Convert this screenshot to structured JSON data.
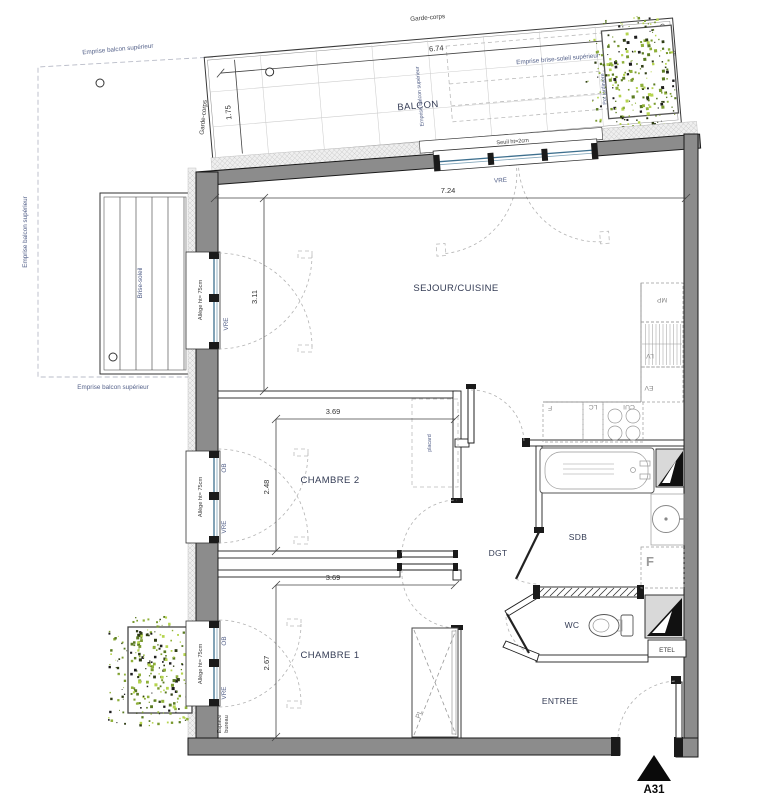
{
  "rooms": {
    "balcon": "BALCON",
    "sejour": "SEJOUR/CUISINE",
    "chambre2": "CHAMBRE 2",
    "chambre1": "CHAMBRE 1",
    "dgt": "DGT",
    "sdb": "SDB",
    "wc": "WC",
    "entree": "ENTREE"
  },
  "dims": {
    "balcon_w": "6.74",
    "balcon_d": "1.75",
    "sejour_w": "7.24",
    "sejour_d": "3.11",
    "ch2_w": "3.69",
    "ch2_d": "2.48",
    "ch1_w": "3.69",
    "ch1_d": "2.67"
  },
  "railing": {
    "top": "Garde-corps",
    "left": "Garde-corps",
    "right": "Garde-corps"
  },
  "emprise": {
    "top": "Emprise balcon supérieur",
    "left": "Emprise balcon supérieur",
    "bottom": "Emprise balcon supérieur",
    "balcony_mid": "Emprise balcon supérieur",
    "brise_soleil": "Emprise brise-soleil supérieur"
  },
  "labels": {
    "brise_soleil": "Brise-soleil",
    "pot_jardiniere": "Pot jardinière",
    "seuil": "Seuil ht=2cm",
    "allege": "Allège ht= 75cm",
    "espace_line1": "Espace",
    "espace_line2": "bureau",
    "placard": "placard",
    "pl": "PL",
    "etel": "ETEL",
    "marker": "A31"
  },
  "windows": {
    "vre": "VRE",
    "ob": "OB"
  },
  "kitchen": {
    "mp": "MP",
    "lv": "LV",
    "ev": "EV",
    "f": "F",
    "lc": "LC",
    "cui": "CUI"
  },
  "sdb_f": "F",
  "colors": {
    "wall": "#8c8c8c",
    "annotation": "#55628a",
    "room_label": "#343c55",
    "glazing": "#3d6f8e",
    "plant_green": "#8fb03a",
    "marker": "#0a0a0a"
  }
}
